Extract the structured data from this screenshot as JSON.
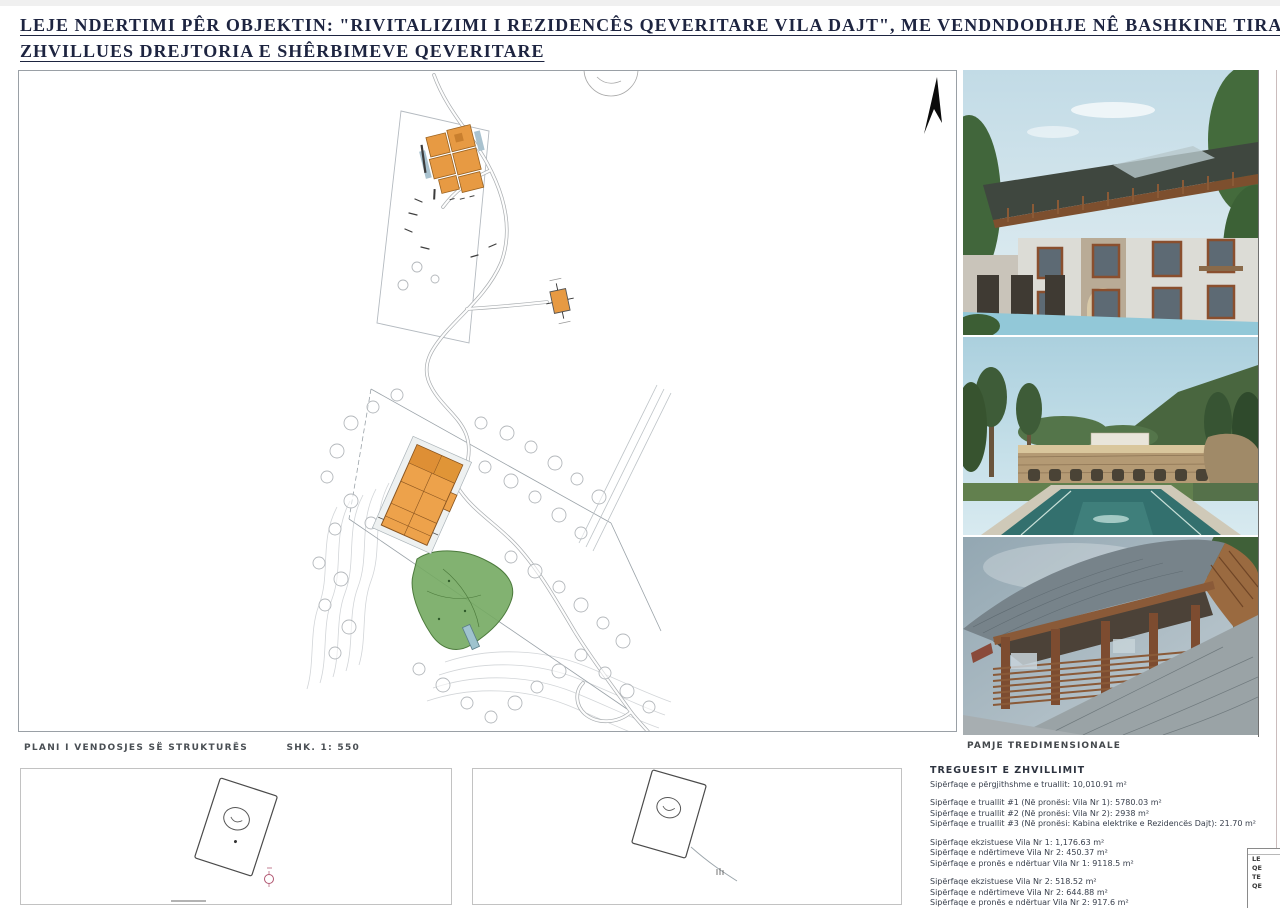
{
  "title": {
    "line1": "LEJE NDERTIMI PÊR OBJEKTIN: \"RIVITALIZIMI I REZIDENCÊS QEVERITARE VILA DAJT\", ME VENDNDODHJE NÊ BASHKINE TIRANE, ME",
    "line2": "ZHVILLUES DREJTORIA E SHÊRBIMEVE QEVERITARE"
  },
  "site_plan": {
    "caption": "PLANI I VENDOSJES SË STRUKTURËS",
    "scale": "SHK. 1: 550",
    "colors": {
      "building_footprint": "#EDA24B",
      "green_area": "#74AA62",
      "title_navy": "#1D2440"
    }
  },
  "photo_panel": {
    "caption": "PAMJE TREDIMENSIONALE",
    "photos": [
      {
        "label": "villa-exterior-3d-view"
      },
      {
        "label": "pool-terrace-3d-view"
      },
      {
        "label": "wooden-pavilion-3d-view"
      }
    ]
  },
  "development_indicators": {
    "heading": "TREGUESIT E ZHVILLIMIT",
    "total": "Sipërfaqe e përgjithshme e truallit: 10,010.91 m²",
    "parcels": [
      "Sipërfaqe e truallit #1 (Në pronësi: Vila Nr 1): 5780.03 m²",
      "Sipërfaqe e truallit #2 (Në pronësi: Vila Nr 2): 2938 m²",
      "Sipërfaqe e truallit #3 (Në pronësi: Kabina elektrike e Rezidencës Dajt): 21.70 m²"
    ],
    "vila1": [
      "Sipërfaqe ekzistuese Vila Nr 1: 1,176.63 m²",
      "Sipërfaqe e ndërtimeve Vila Nr 2: 450.37 m²",
      "Sipërfaqe e pronës e ndërtuar Vila Nr 1: 9118.5 m²"
    ],
    "vila2": [
      "Sipërfaqe ekzistuese Vila Nr 2: 518.52 m²",
      "Sipërfaqe e ndërtimeve Vila Nr 2: 644.88 m²",
      "Sipërfaqe e pronës e ndërtuar Vila Nr 2: 917.6 m²"
    ]
  },
  "side_table": {
    "rows": [
      "LE",
      "QE",
      "TE",
      "QE"
    ]
  }
}
